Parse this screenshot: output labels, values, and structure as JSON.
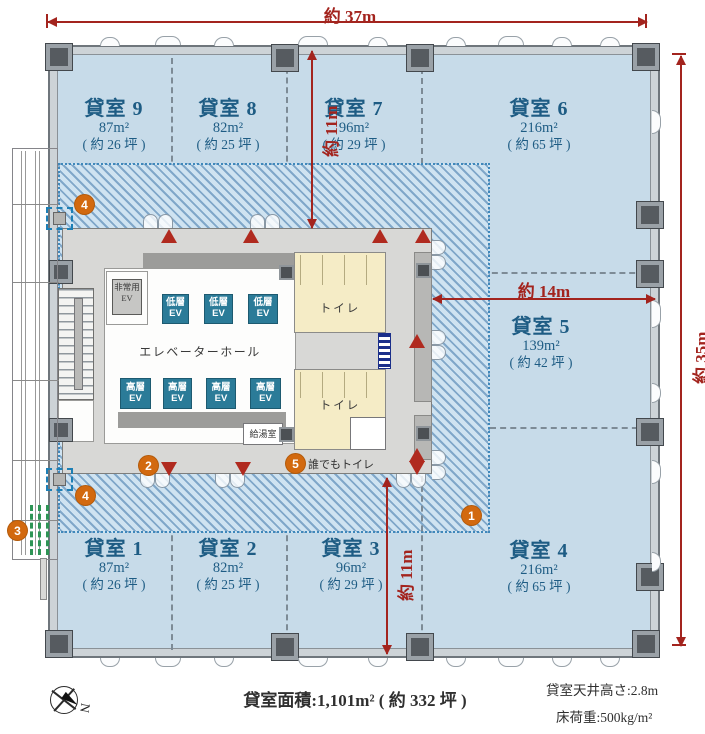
{
  "dimensions": {
    "width_top": "約 37m",
    "height_right": "約 35m",
    "depth_upper": "約 11m",
    "depth_lower": "約 11m",
    "width_mid": "約 14m"
  },
  "rooms": [
    {
      "name": "貸室 1",
      "area": "87m²",
      "tsubo": "( 約 26 坪 )"
    },
    {
      "name": "貸室 2",
      "area": "82m²",
      "tsubo": "( 約 25 坪 )"
    },
    {
      "name": "貸室 3",
      "area": "96m²",
      "tsubo": "( 約 29 坪 )"
    },
    {
      "name": "貸室 4",
      "area": "216m²",
      "tsubo": "( 約 65 坪 )"
    },
    {
      "name": "貸室 5",
      "area": "139m²",
      "tsubo": "( 約 42 坪 )"
    },
    {
      "name": "貸室 6",
      "area": "216m²",
      "tsubo": "( 約 65 坪 )"
    },
    {
      "name": "貸室 7",
      "area": "96m²",
      "tsubo": "( 約 29 坪 )"
    },
    {
      "name": "貸室 8",
      "area": "82m²",
      "tsubo": "( 約 25 坪 )"
    },
    {
      "name": "貸室 9",
      "area": "87m²",
      "tsubo": "( 約 26 坪 )"
    }
  ],
  "core": {
    "elevator_hall": "エレベーターホール",
    "emergency_line1": "非常用",
    "low_ev": "低層",
    "high_ev": "高層",
    "ev": "EV",
    "toilet": "トイレ",
    "kitchenette": "給湯室",
    "accessible_toilet": "誰でもトイレ"
  },
  "markers": {
    "one": "1",
    "two": "2",
    "three": "3",
    "four": "4",
    "five": "5"
  },
  "footer": {
    "total_area": "貸室面積:1,101m² ( 約 332 坪 )",
    "ceiling_height": "貸室天井高さ:2.8m",
    "floor_load": "床荷重:500kg/m²",
    "compass_north": "N"
  },
  "colors": {
    "dimension_red": "#a3241e",
    "marker_orange": "#d2690f",
    "room_text_blue": "#1e5c84",
    "elevator_teal": "#2b7b98",
    "room_fill": "#c7dbe9",
    "toilet_beige": "#f5ecc6"
  }
}
